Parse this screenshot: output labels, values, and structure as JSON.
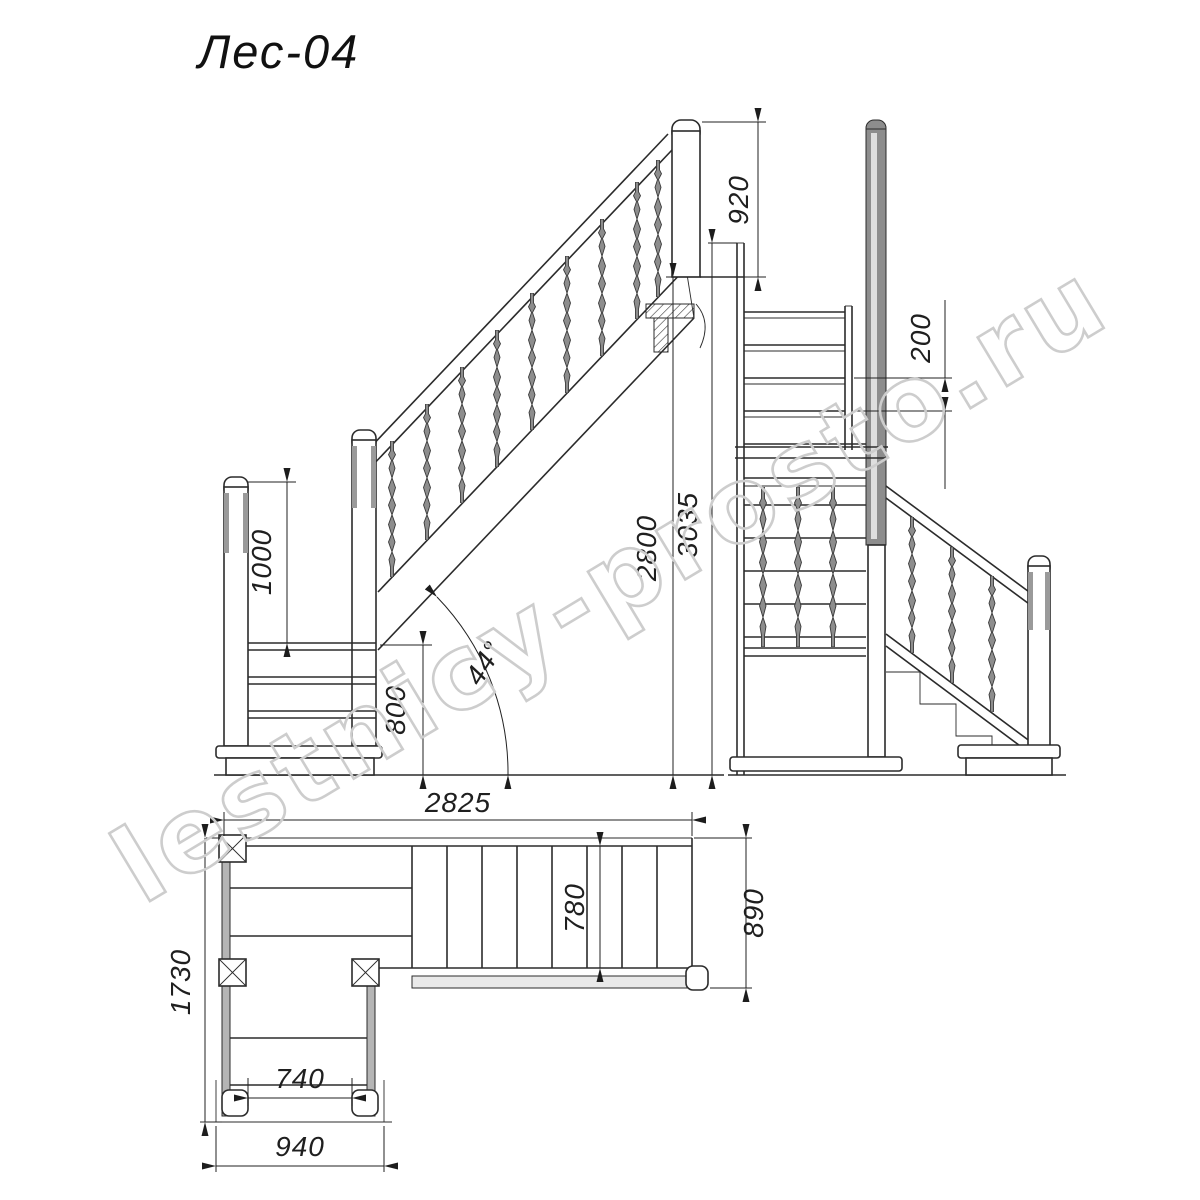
{
  "title": "Лес-04",
  "watermark": "lestnicy-prosto.ru",
  "dims": {
    "top_post_height": "920",
    "step_rise": "200",
    "landing_rail_height": "1000",
    "landing_height": "800",
    "floor_to_floor_height": "2800",
    "overall_height": "3035",
    "overall_length": "2825",
    "incline_angle": "44°",
    "plan_depth": "1730",
    "lower_flight_inner_width": "740",
    "lower_flight_outer_width": "940",
    "tread_width": "780",
    "upper_flight_outer_width": "890"
  }
}
